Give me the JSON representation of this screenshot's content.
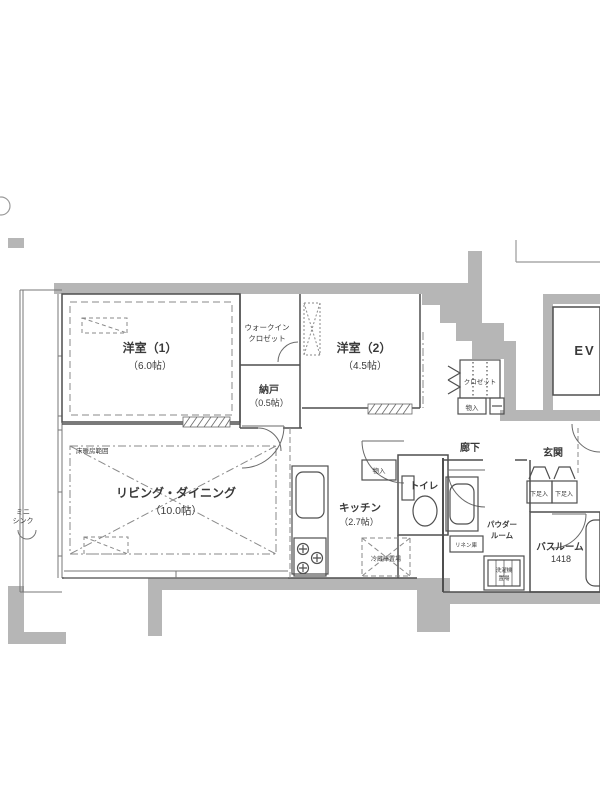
{
  "plan": {
    "rooms": {
      "room1_name": "洋室（1）",
      "room1_size": "（6.0帖）",
      "wic_line1": "ウォークイン",
      "wic_line2": "クロゼット",
      "nando_name": "納戸",
      "nando_size": "（0.5帖）",
      "room2_name": "洋室（2）",
      "room2_size": "（4.5帖）",
      "living_name": "リビング・ダイニング",
      "living_size": "（10.0帖）",
      "kitchen_name": "キッチン",
      "kitchen_size": "（2.7帖）",
      "toilet_name": "トイレ",
      "powder_line1": "パウダー",
      "powder_line2": "ルーム",
      "bath_name": "バスルーム",
      "bath_size": "1418",
      "entrance_name": "玄関",
      "hallway_name": "廊下",
      "elevator_name": "EV"
    },
    "fixtures": {
      "closet": "クロゼット",
      "storage_room2": "物入",
      "storage_hall": "物入",
      "shoe_cabinet_left": "下足入",
      "shoe_cabinet_right": "下足入",
      "fridge_space": "冷蔵庫置場",
      "washer_line1": "洗濯機",
      "washer_line2": "置場",
      "linen": "リネン庫",
      "mini_sink_line1": "ミニ",
      "mini_sink_line2": "シンク",
      "floor_heating": "床暖房範囲"
    },
    "colors": {
      "wall": "#b6b6b6",
      "line": "#4f4f4f",
      "dashed": "#888888",
      "floor_heating_text": "#8a9348"
    }
  }
}
